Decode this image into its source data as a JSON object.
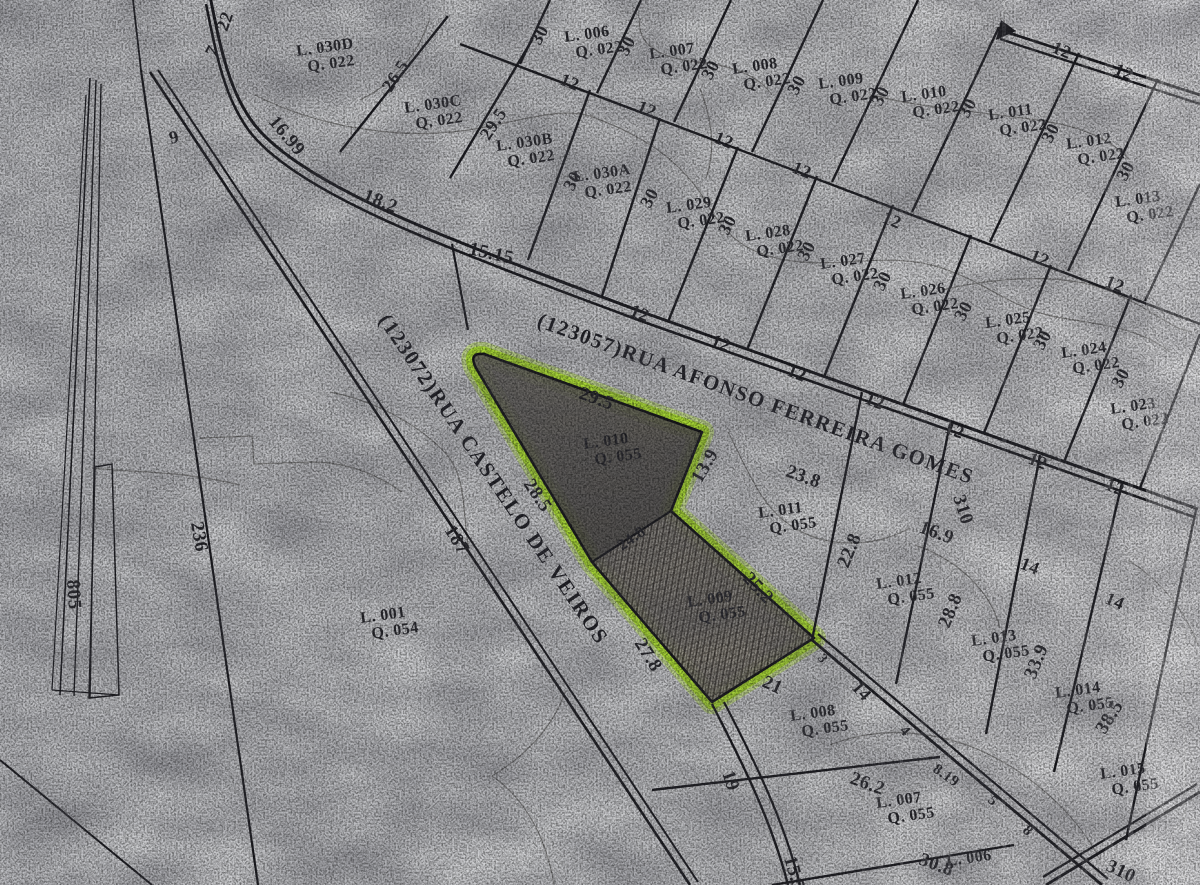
{
  "map": {
    "type": "cadastral-plat-scan",
    "paper_color": "#d3d4d6",
    "ink_color": "#1a1a1f",
    "highlight_color": "#b2ea2b",
    "shaded_lot_fill": "#56534e",
    "highlighted_lots": [
      "L. 010 Q. 055",
      "L. 009 Q. 055"
    ],
    "streets": [
      {
        "name": "(123057)RUA AFONSO FERREIRA GOMES",
        "x": 536,
        "y": 326,
        "r": 20
      },
      {
        "name": "(123072)RUA CASTELO DE VEIROS",
        "x": 378,
        "y": 320,
        "r": 56
      }
    ],
    "lots": [
      {
        "id": "L. 006",
        "q": "Q. 022",
        "x": 565,
        "y": 42
      },
      {
        "id": "L. 007",
        "q": "Q. 022",
        "x": 650,
        "y": 59
      },
      {
        "id": "L. 008",
        "q": "Q. 022",
        "x": 733,
        "y": 74
      },
      {
        "id": "L. 009",
        "q": "Q. 022",
        "x": 819,
        "y": 89
      },
      {
        "id": "L. 010",
        "q": "Q. 022",
        "x": 902,
        "y": 102
      },
      {
        "id": "L. 011",
        "q": "Q. 022",
        "x": 989,
        "y": 120
      },
      {
        "id": "L. 012",
        "q": "Q. 022",
        "x": 1067,
        "y": 149
      },
      {
        "id": "L. 013",
        "q": "Q. 022",
        "x": 1116,
        "y": 207
      },
      {
        "id": "L. 030D",
        "q": "Q. 022",
        "x": 297,
        "y": 56
      },
      {
        "id": "L. 030C",
        "q": "Q. 022",
        "x": 405,
        "y": 113
      },
      {
        "id": "L. 030B",
        "q": "Q. 022",
        "x": 497,
        "y": 151
      },
      {
        "id": "L. 030A",
        "q": "Q. 022",
        "x": 574,
        "y": 182
      },
      {
        "id": "L. 029",
        "q": "Q. 022",
        "x": 667,
        "y": 213
      },
      {
        "id": "L. 028",
        "q": "Q. 022",
        "x": 746,
        "y": 241
      },
      {
        "id": "L. 027",
        "q": "Q. 022",
        "x": 821,
        "y": 269
      },
      {
        "id": "L. 026",
        "q": "Q. 022",
        "x": 901,
        "y": 299
      },
      {
        "id": "L. 025",
        "q": "Q. 022",
        "x": 986,
        "y": 328
      },
      {
        "id": "L. 024",
        "q": "Q. 022",
        "x": 1062,
        "y": 358
      },
      {
        "id": "L. 023",
        "q": "Q. 022",
        "x": 1111,
        "y": 414
      },
      {
        "id": "L. 010",
        "q": "Q. 055",
        "x": 584,
        "y": 449
      },
      {
        "id": "L. 009",
        "q": "Q. 055",
        "x": 688,
        "y": 607
      },
      {
        "id": "L. 011",
        "q": "Q. 055",
        "x": 759,
        "y": 518
      },
      {
        "id": "L. 012",
        "q": "Q. 055",
        "x": 877,
        "y": 589
      },
      {
        "id": "L. 013",
        "q": "Q. 055",
        "x": 972,
        "y": 646
      },
      {
        "id": "L. 014",
        "q": "Q. 055",
        "x": 1056,
        "y": 698
      },
      {
        "id": "L. 015",
        "q": "Q. 055",
        "x": 1101,
        "y": 779
      },
      {
        "id": "L. 008",
        "q": "Q. 055",
        "x": 791,
        "y": 721
      },
      {
        "id": "L. 007",
        "q": "Q. 055",
        "x": 877,
        "y": 808
      },
      {
        "id": "L. 006",
        "q": "",
        "x": 947,
        "y": 866
      },
      {
        "id": "L. 001",
        "q": "Q. 054",
        "x": 361,
        "y": 623
      }
    ],
    "measurements": [
      {
        "v": "22",
        "x": 227,
        "y": 32,
        "r": -70
      },
      {
        "v": "7",
        "x": 215,
        "y": 58,
        "r": -62
      },
      {
        "v": "9",
        "x": 171,
        "y": 144,
        "r": -15
      },
      {
        "v": "16.99",
        "x": 268,
        "y": 122,
        "r": 50,
        "s": 19
      },
      {
        "v": "18.2",
        "x": 362,
        "y": 200,
        "r": 22,
        "s": 19
      },
      {
        "v": "15.15",
        "x": 468,
        "y": 254,
        "r": 13,
        "s": 19
      },
      {
        "v": "26.5",
        "x": 391,
        "y": 93,
        "r": -57
      },
      {
        "v": "29.5",
        "x": 489,
        "y": 141,
        "r": -57
      },
      {
        "v": "30",
        "x": 540,
        "y": 46,
        "r": -62
      },
      {
        "v": "30",
        "x": 627,
        "y": 57,
        "r": -62
      },
      {
        "v": "30",
        "x": 711,
        "y": 81,
        "r": -62
      },
      {
        "v": "30",
        "x": 797,
        "y": 96,
        "r": -62
      },
      {
        "v": "30",
        "x": 881,
        "y": 107,
        "r": -62
      },
      {
        "v": "30",
        "x": 968,
        "y": 119,
        "r": -62
      },
      {
        "v": "30",
        "x": 1051,
        "y": 144,
        "r": -62
      },
      {
        "v": "30",
        "x": 1126,
        "y": 182,
        "r": -62
      },
      {
        "v": "30",
        "x": 573,
        "y": 192,
        "r": -62
      },
      {
        "v": "30",
        "x": 650,
        "y": 209,
        "r": -62
      },
      {
        "v": "30",
        "x": 728,
        "y": 236,
        "r": -62
      },
      {
        "v": "30",
        "x": 807,
        "y": 262,
        "r": -62
      },
      {
        "v": "30",
        "x": 883,
        "y": 292,
        "r": -62
      },
      {
        "v": "30",
        "x": 964,
        "y": 322,
        "r": -62
      },
      {
        "v": "30",
        "x": 1043,
        "y": 351,
        "r": -62
      },
      {
        "v": "30",
        "x": 1121,
        "y": 389,
        "r": -62
      },
      {
        "v": "12",
        "x": 559,
        "y": 84,
        "r": 22
      },
      {
        "v": "12",
        "x": 636,
        "y": 111,
        "r": 22
      },
      {
        "v": "12",
        "x": 713,
        "y": 142,
        "r": 22
      },
      {
        "v": "12",
        "x": 791,
        "y": 172,
        "r": 22
      },
      {
        "v": "12",
        "x": 881,
        "y": 222,
        "r": 22
      },
      {
        "v": "12",
        "x": 1029,
        "y": 260,
        "r": 22
      },
      {
        "v": "12",
        "x": 1104,
        "y": 286,
        "r": 22
      },
      {
        "v": "12",
        "x": 1051,
        "y": 52,
        "r": 22
      },
      {
        "v": "12",
        "x": 1113,
        "y": 74,
        "r": 22
      },
      {
        "v": "12",
        "x": 629,
        "y": 315,
        "r": 22
      },
      {
        "v": "12",
        "x": 710,
        "y": 345,
        "r": 22
      },
      {
        "v": "12",
        "x": 786,
        "y": 375,
        "r": 22
      },
      {
        "v": "12",
        "x": 864,
        "y": 403,
        "r": 22
      },
      {
        "v": "12",
        "x": 944,
        "y": 432,
        "r": 22
      },
      {
        "v": "12",
        "x": 1027,
        "y": 463,
        "r": 22
      },
      {
        "v": "12",
        "x": 1104,
        "y": 489,
        "r": 22
      },
      {
        "v": "310",
        "x": 953,
        "y": 497,
        "r": 72,
        "s": 19
      },
      {
        "v": "16.9",
        "x": 918,
        "y": 532,
        "r": 20,
        "s": 19
      },
      {
        "v": "23.8",
        "x": 785,
        "y": 476,
        "r": 20,
        "s": 19
      },
      {
        "v": "13.9",
        "x": 701,
        "y": 484,
        "r": -60,
        "s": 19
      },
      {
        "v": "29.5",
        "x": 578,
        "y": 398,
        "r": 20,
        "s": 19
      },
      {
        "v": "28.5",
        "x": 523,
        "y": 484,
        "r": 56,
        "s": 19
      },
      {
        "v": "24.8",
        "x": 622,
        "y": 551,
        "r": -35,
        "s": 16
      },
      {
        "v": "25.2",
        "x": 742,
        "y": 579,
        "r": 47,
        "s": 19
      },
      {
        "v": "27.8",
        "x": 634,
        "y": 643,
        "r": 58,
        "s": 19
      },
      {
        "v": "21",
        "x": 761,
        "y": 686,
        "r": 25,
        "s": 19
      },
      {
        "v": "3",
        "x": 817,
        "y": 658,
        "r": 55,
        "s": 14
      },
      {
        "v": "22.8",
        "x": 848,
        "y": 569,
        "r": -68,
        "s": 19
      },
      {
        "v": "28.8",
        "x": 949,
        "y": 629,
        "r": -68,
        "s": 19
      },
      {
        "v": "33.9",
        "x": 1035,
        "y": 680,
        "r": -68,
        "s": 19
      },
      {
        "v": "38.5",
        "x": 1105,
        "y": 735,
        "r": -58,
        "s": 19
      },
      {
        "v": "14",
        "x": 1019,
        "y": 568,
        "r": 22
      },
      {
        "v": "14",
        "x": 1104,
        "y": 603,
        "r": 22
      },
      {
        "v": "14",
        "x": 851,
        "y": 688,
        "r": 48
      },
      {
        "v": "4",
        "x": 899,
        "y": 731,
        "r": 48,
        "s": 15
      },
      {
        "v": "8.19",
        "x": 932,
        "y": 771,
        "r": 35,
        "s": 15
      },
      {
        "v": "5",
        "x": 987,
        "y": 801,
        "r": 45,
        "s": 15
      },
      {
        "v": "8",
        "x": 1022,
        "y": 831,
        "r": 45,
        "s": 15
      },
      {
        "v": "7",
        "x": 1061,
        "y": 863,
        "r": 40,
        "s": 15
      },
      {
        "v": "19",
        "x": 722,
        "y": 773,
        "r": 72,
        "s": 19
      },
      {
        "v": "26.2",
        "x": 849,
        "y": 783,
        "r": 20,
        "s": 19
      },
      {
        "v": "15.5",
        "x": 784,
        "y": 858,
        "r": 74,
        "s": 19
      },
      {
        "v": "30.8",
        "x": 918,
        "y": 864,
        "r": 20,
        "s": 19
      },
      {
        "v": "310",
        "x": 1105,
        "y": 870,
        "r": 25,
        "s": 19
      },
      {
        "v": "236",
        "x": 191,
        "y": 523,
        "r": 80,
        "s": 19
      },
      {
        "v": "805",
        "x": 67,
        "y": 580,
        "r": 86,
        "s": 19
      },
      {
        "v": "187",
        "x": 444,
        "y": 530,
        "r": 58,
        "s": 19
      }
    ]
  }
}
